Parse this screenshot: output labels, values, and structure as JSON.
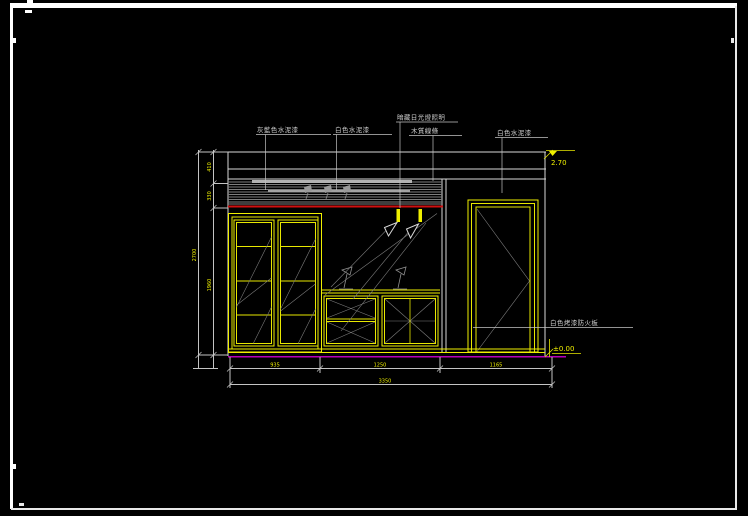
{
  "page": {
    "background": "#000000",
    "frame_color": "#ffffff"
  },
  "colors": {
    "line_yellow": "#f0f000",
    "line_white": "#d9d9d9",
    "line_gray": "#8f8f8f",
    "line_red": "#d01010",
    "line_magenta": "#b800b8",
    "text_label": "#cfcfcf",
    "text_dimension": "#f0f000"
  },
  "annotations": {
    "top_labels": [
      {
        "text": "灰藍色水泥漆"
      },
      {
        "text": "白色水泥漆"
      },
      {
        "text": "暗藏日光燈照明"
      },
      {
        "text": "木質線條"
      },
      {
        "text": "白色水泥漆"
      }
    ],
    "side_label": {
      "text": "白色烤漆防火板"
    }
  },
  "levels": {
    "ceiling": "2.70",
    "floor": "±0.00"
  },
  "dimensions": {
    "bottom": {
      "segments": [
        "935",
        "1250",
        "1165"
      ],
      "total": "3350"
    },
    "left": {
      "segments": [
        "410",
        "330",
        "1960"
      ],
      "total": "2700"
    }
  }
}
